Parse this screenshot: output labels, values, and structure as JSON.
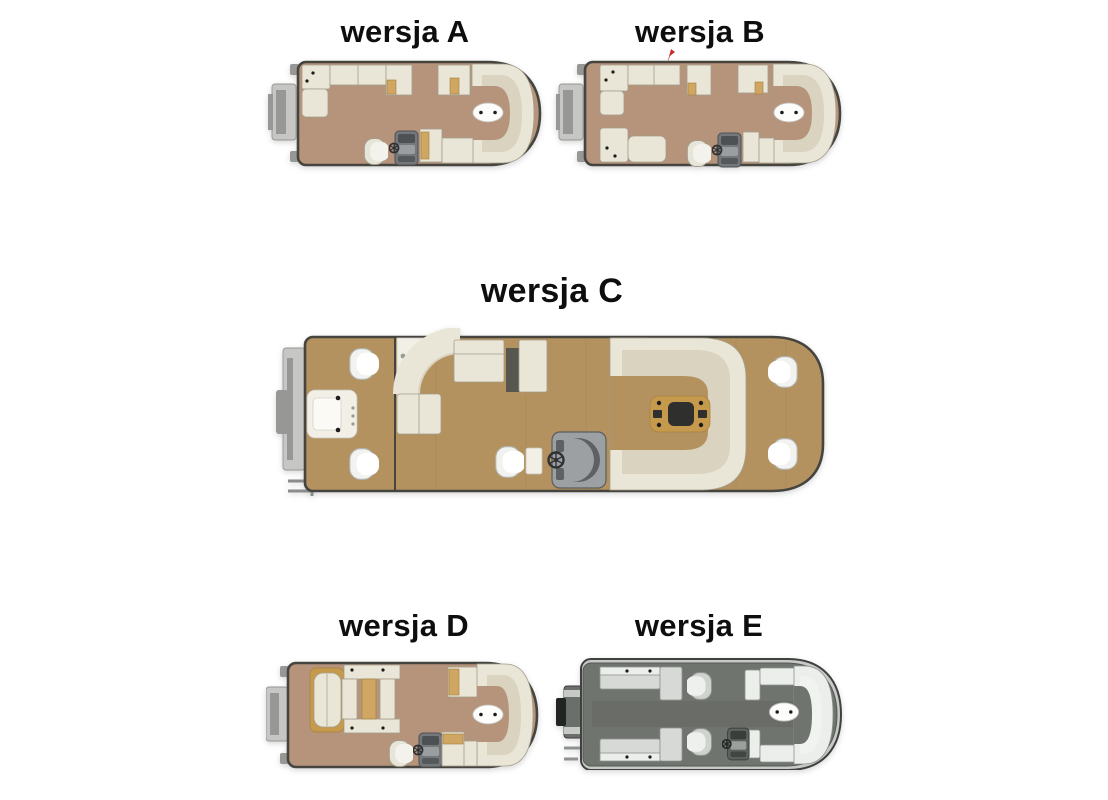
{
  "page": {
    "background": "#ffffff"
  },
  "figures": [
    {
      "id": "version-a",
      "title": "wersja A"
    },
    {
      "id": "version-b",
      "title": "wersja B"
    },
    {
      "id": "version-c",
      "title": "wersja C"
    },
    {
      "id": "version-d",
      "title": "wersja D"
    },
    {
      "id": "version-e",
      "title": "wersja E"
    }
  ],
  "colors": {
    "page_bg": "#ffffff",
    "title_text": "#0e0e0e",
    "hull_outline": "#45443f",
    "deck_tan": "#b6947c",
    "deck_gold": "#b3925f",
    "deck_gray": "#70746e",
    "seat_cream": "#e9e5d7",
    "seat_cream_shade": "#d9d3c0",
    "seat_stroke": "#a49e8b",
    "platform_white": "#f1efe6",
    "pillow_tan": "#cfa662",
    "pillow_stroke": "#a5803f",
    "chair_fill": "#e7e4d8",
    "chair_inner": "#f4f2ec",
    "console_gray": "#75787b",
    "console_dark": "#4e5154",
    "console_light": "#9b9ea1",
    "table_white": "#fdfdfc",
    "table_stroke": "#c6c5be",
    "table_wood": "#c59a4d",
    "table_wood_dark": "#2f2f2d",
    "dot_black": "#1c1c1c",
    "dot_gray": "#9a9a96",
    "seat_gray_e": "#d6d9d6",
    "seat_gray_e_light": "#ebeeeb",
    "seat_gray_e_stroke": "#8f938f",
    "motor_light": "#c6c6c4",
    "motor_mid": "#979795",
    "motor_dark": "#6b6f6c",
    "storage_dark": "#57564f",
    "flag_red": "#c62d2d"
  }
}
